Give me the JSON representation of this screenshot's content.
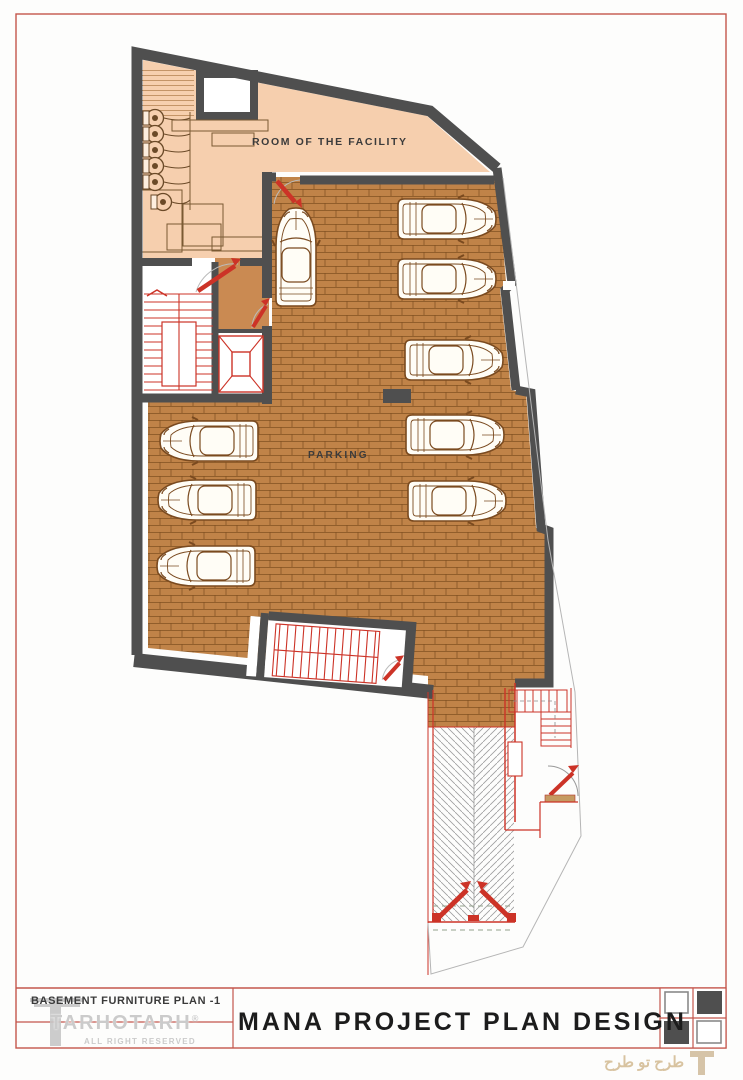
{
  "plan": {
    "room_facility_label": "ROOM OF THE FACILITY",
    "parking_label": "PARKING"
  },
  "title_block": {
    "drawing_name": "BASEMENT FURNITURE PLAN -1",
    "project_title": "MANA PROJECT PLAN DESIGN",
    "brand": "TARHOTARH",
    "registered_mark": "®",
    "rights": "ALL RIGHT RESERVED"
  },
  "watermark": {
    "text": "طرح تو طرح"
  },
  "colors": {
    "wall": "#4f4f4f",
    "facility_floor": "#f6cfae",
    "vestibule_floor": "#ca8a52",
    "parking_floor": "#c08348",
    "brick_line": "#7d4e1f",
    "accent_red": "#cc3327",
    "sheet_border": "#c4564c",
    "logo_gray": "#cbcbcb",
    "checker_dark": "#4f4f4f"
  }
}
